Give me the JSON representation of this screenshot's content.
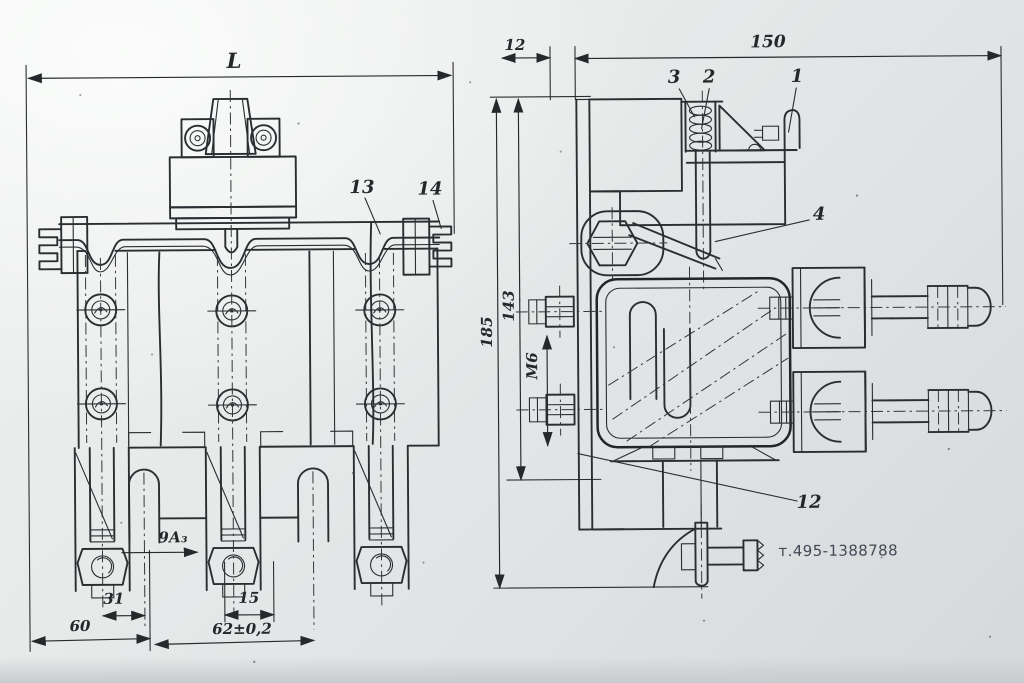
{
  "drawing": {
    "watermark": "т.495-1388788",
    "left_view": {
      "dim_L": "L",
      "dim_9a3": "9А₃",
      "dim_31": "31",
      "dim_15": "15",
      "dim_60": "60",
      "dim_62": "62±0,2",
      "callout_13": "13",
      "callout_14": "14"
    },
    "right_view": {
      "dim_12": "12",
      "dim_150": "150",
      "dim_185": "185",
      "dim_143": "143",
      "dim_m6": "М6",
      "callout_1": "1",
      "callout_2": "2",
      "callout_3": "3",
      "callout_4": "4",
      "callout_12": "12"
    }
  }
}
